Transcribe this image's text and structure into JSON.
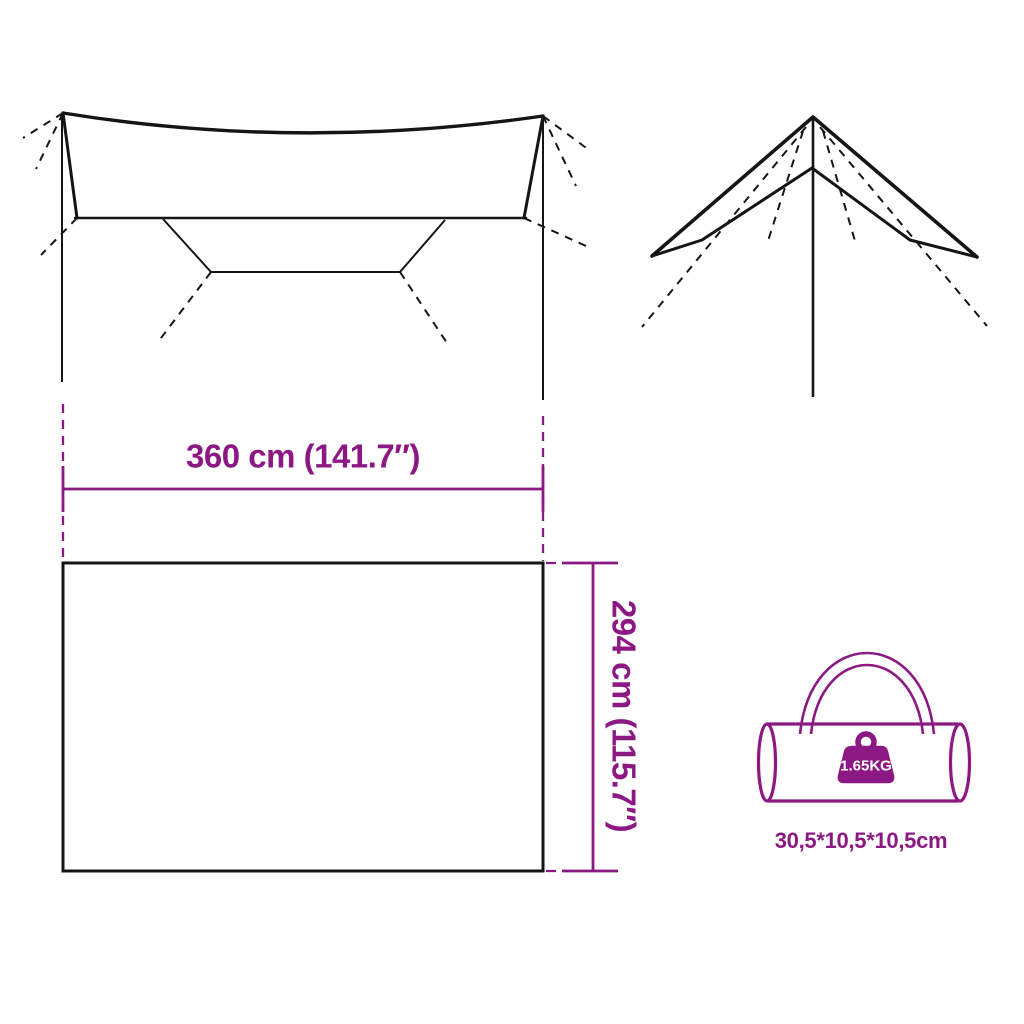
{
  "colors": {
    "accent": "#8C1983",
    "line": "#151515",
    "background": "#FFFFFF"
  },
  "dimensions": {
    "width_label": "360 cm (141.7″)",
    "height_label": "294 cm (115.7″)"
  },
  "bag": {
    "weight_label": "1.65KG",
    "size_label": "30,5*10,5*10,5cm"
  },
  "icons": {
    "weight_icon": "weight-kg-icon",
    "carry_bag": "duffel-bag-icon"
  }
}
